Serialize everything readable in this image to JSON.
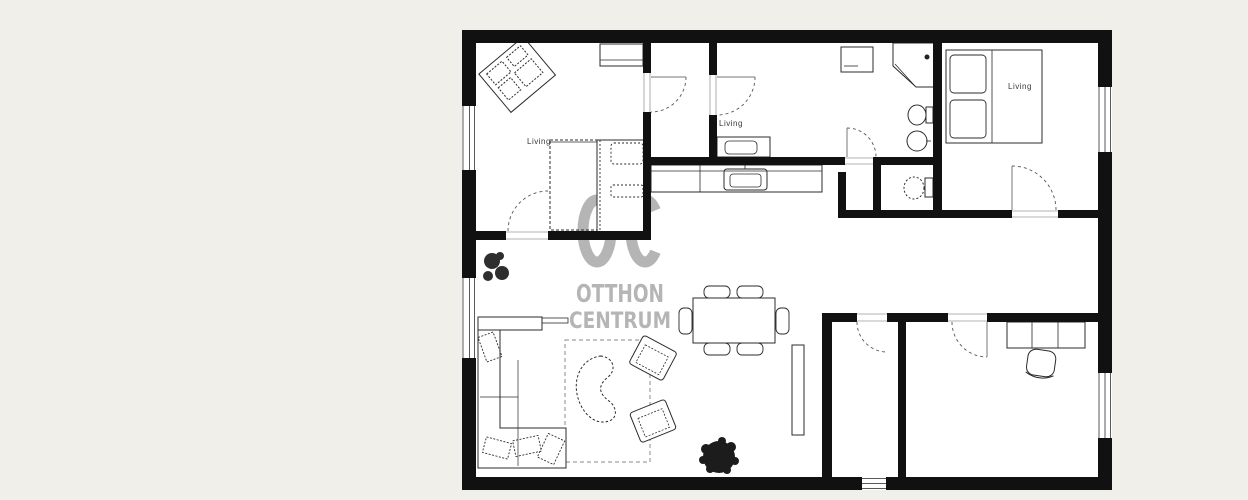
{
  "page": {
    "type": "real-estate-floor-plan",
    "background_color": "#f0efe9",
    "paper_color": "#ffffff",
    "wall_color": "#111111",
    "furniture_line_color": "#2b2b2b"
  },
  "watermark": {
    "icon": "house-roof-icon",
    "monogram": "OC",
    "line2": "OTTHON",
    "line3": "CENTRUM",
    "color": "#b5b5b5"
  },
  "labels": [
    {
      "text": "Living",
      "x": 527,
      "y": 137
    },
    {
      "text": "Living",
      "x": 719,
      "y": 119
    },
    {
      "text": "Living",
      "x": 1008,
      "y": 82
    }
  ],
  "objects": [
    "desk-corner-group",
    "wardrobe",
    "double-bed-small-room",
    "closet-dashed",
    "hall-cabinet-washbasin",
    "corner-shower",
    "washing-machine",
    "toilet",
    "wall-sink",
    "wc-toilet",
    "double-bed-master",
    "kitchen-counter",
    "kitchen-sink",
    "dining-table",
    "dining-chairs",
    "l-shaped-sofa",
    "coffee-table-bean",
    "armchair",
    "armchair",
    "rug-dashed",
    "sideboard",
    "shelf-unit",
    "office-desk",
    "office-chair",
    "plant-large",
    "plant-small",
    "window",
    "door-arc"
  ]
}
